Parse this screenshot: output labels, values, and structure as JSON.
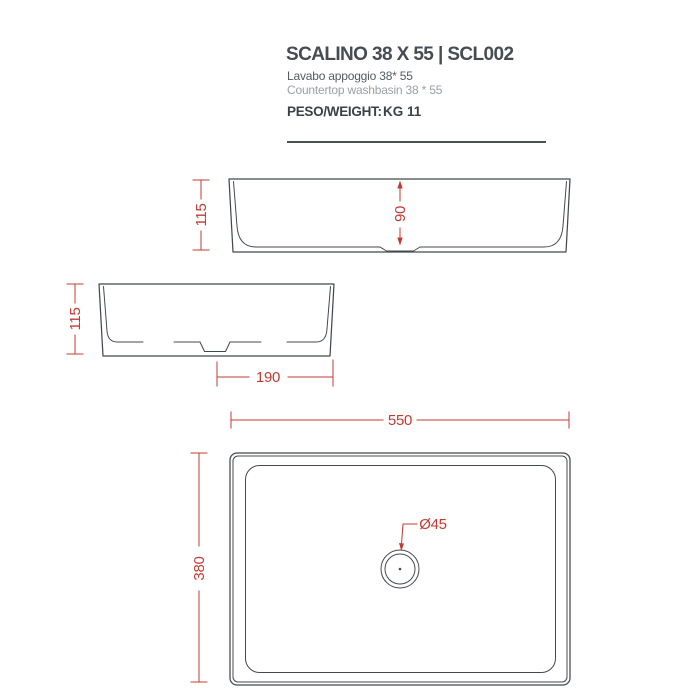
{
  "header": {
    "title": "SCALINO 38 X 55 | SCL002",
    "subtitle_it": "Lavabo appoggio 38* 55",
    "subtitle_en": "Countertop washbasin 38 * 55",
    "weight_label": "PESO/WEIGHT:",
    "weight_value": "KG 11"
  },
  "dimensions": {
    "front_total_height": "115",
    "front_basin_depth": "90",
    "side_total_height": "115",
    "side_drain_offset": "190",
    "top_width": "550",
    "top_depth": "380",
    "drain_diameter": "Ø45"
  },
  "colors": {
    "drawing_line": "#44494e",
    "dimension_red": "#c23b34",
    "title_text": "#474c52",
    "muted_text": "#9aa0a5",
    "background": "#ffffff"
  }
}
